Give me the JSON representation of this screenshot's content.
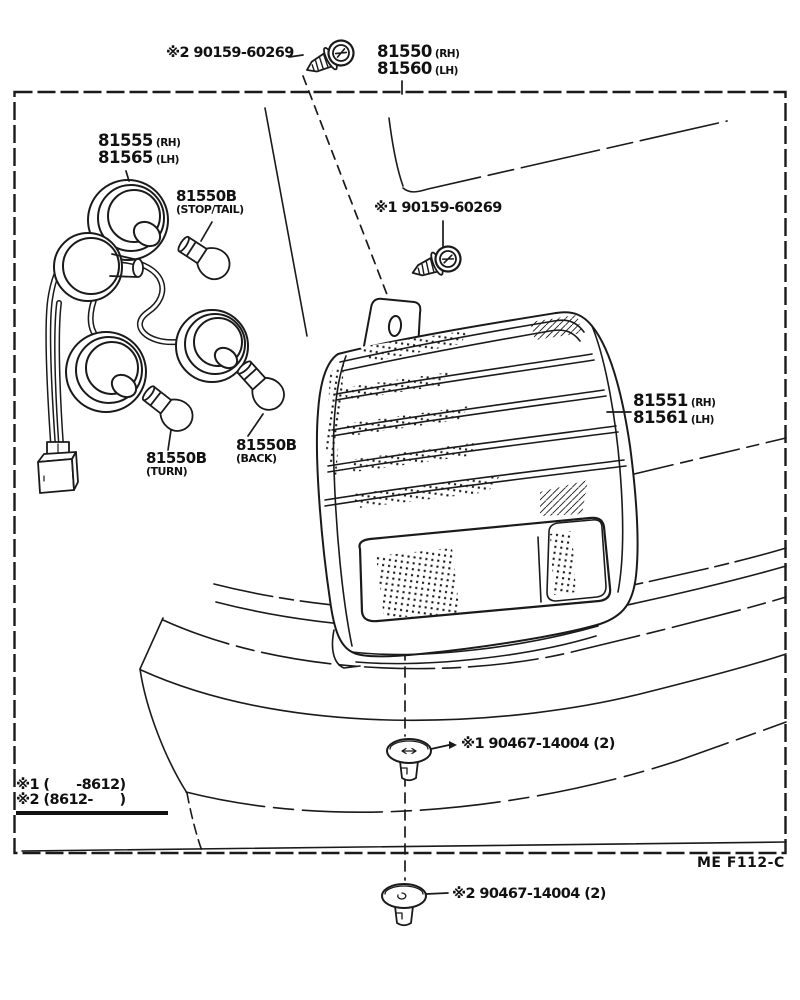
{
  "diagram": {
    "code": "ME  F112-C",
    "footnotes": {
      "note1": "※1 (      -8612)",
      "note2": "※2 (8612-      )"
    },
    "parts": {
      "screw_upper": {
        "label": "※2 90159-60269"
      },
      "screw_lower": {
        "label": "※1 90159-60269"
      },
      "lamp_assembly": {
        "rh_no": "81550",
        "rh_side": "(RH)",
        "lh_no": "81560",
        "lh_side": "(LH)"
      },
      "lens_body": {
        "rh_no": "81551",
        "rh_side": "(RH)",
        "lh_no": "81561",
        "lh_side": "(LH)"
      },
      "socket_wire": {
        "rh_no": "81555",
        "rh_side": "(RH)",
        "lh_no": "81565",
        "lh_side": "(LH)"
      },
      "bulb_stop_tail": {
        "number": "81550B",
        "function": "(STOP/TAIL)"
      },
      "bulb_turn": {
        "number": "81550B",
        "function": "(TURN)"
      },
      "bulb_back": {
        "number": "81550B",
        "function": "(BACK)"
      },
      "clip_upper": {
        "label": "※1 90467-14004 (2)"
      },
      "clip_lower": {
        "label": "※2 90467-14004 (2)"
      }
    }
  }
}
